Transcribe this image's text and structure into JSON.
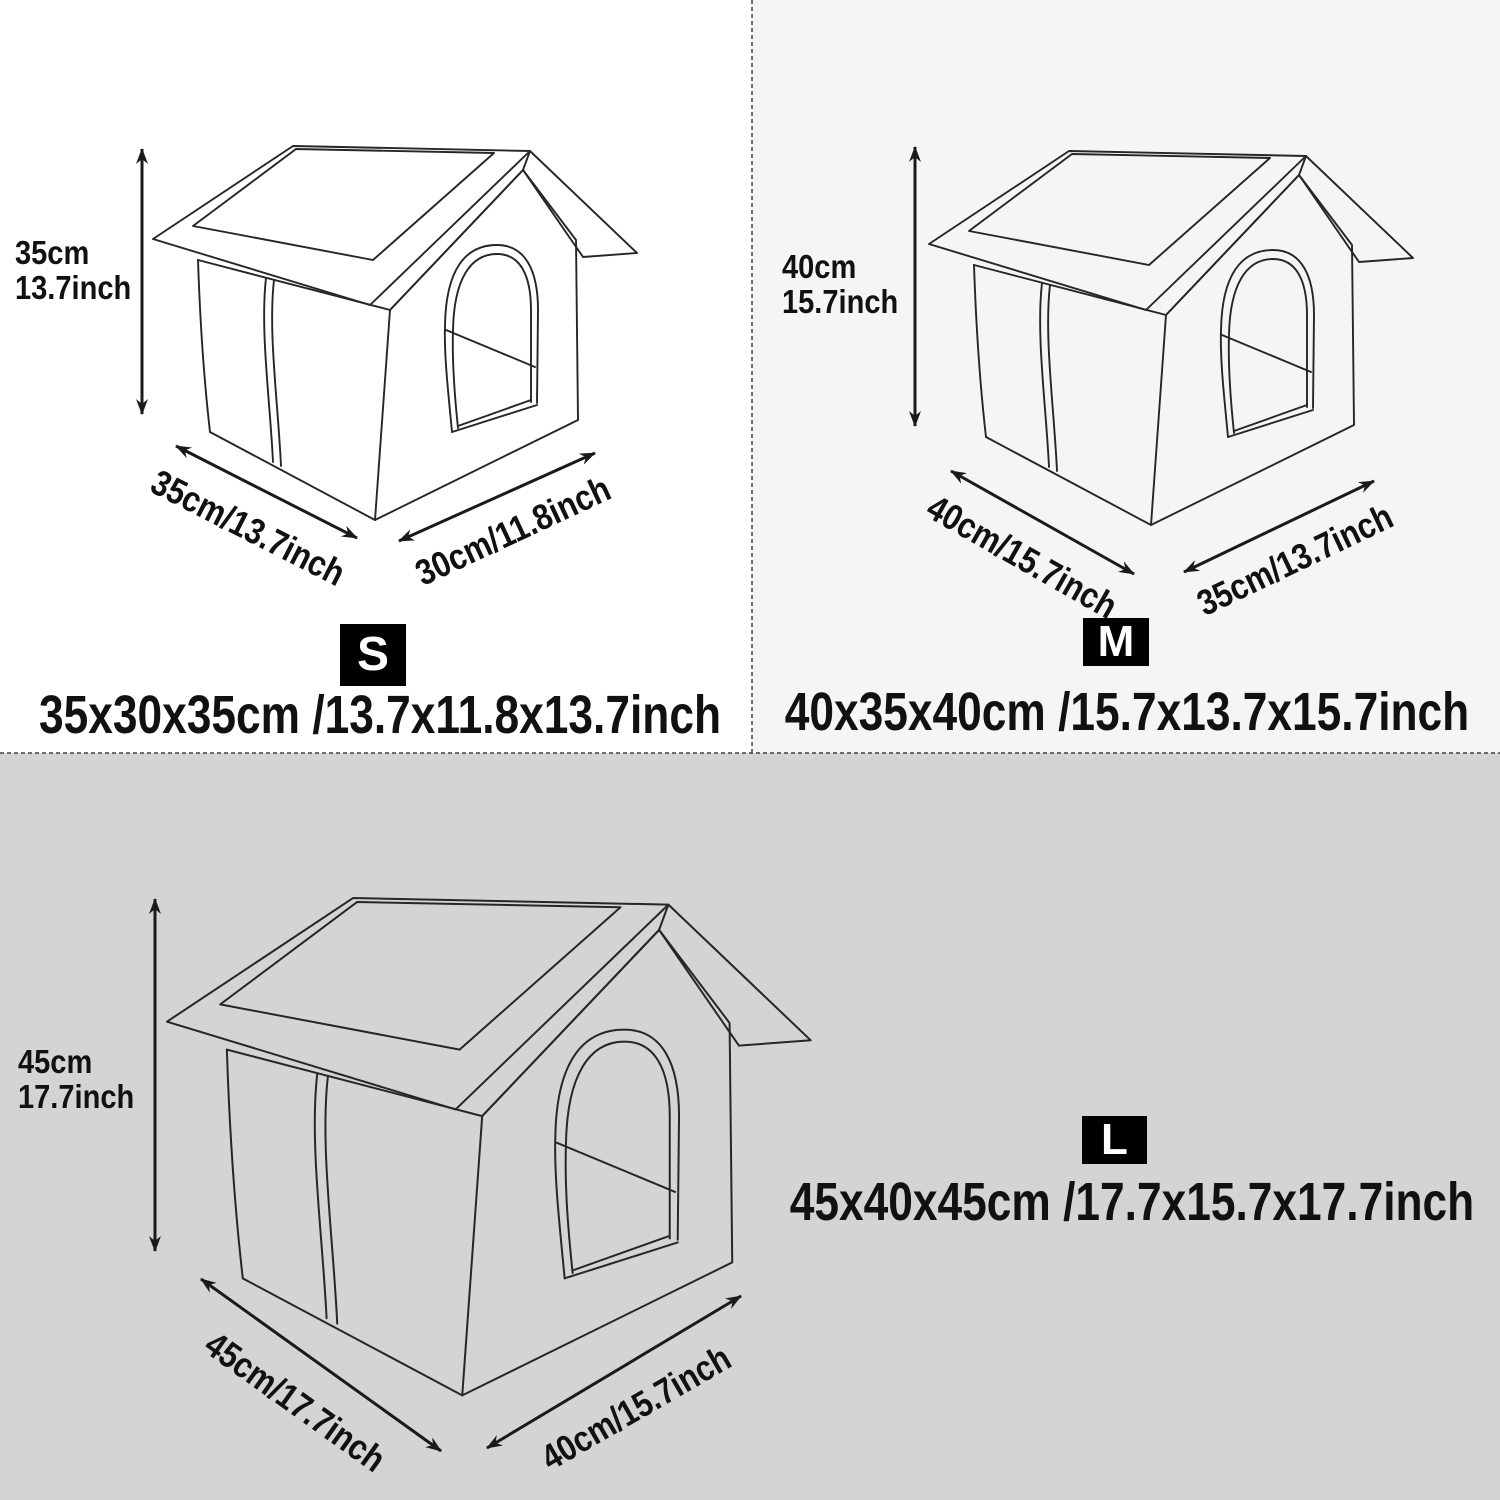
{
  "diagram": {
    "type": "product-size-chart",
    "subject": "house-shaped pet shelter line drawing",
    "sizes": [
      {
        "badge": "S",
        "height_cm": "35cm",
        "height_inch": "13.7inch",
        "width_label": "35cm/13.7inch",
        "depth_label": "30cm/11.8inch",
        "summary": "35x30x35cm /13.7x11.8x13.7inch"
      },
      {
        "badge": "M",
        "height_cm": "40cm",
        "height_inch": "15.7inch",
        "width_label": "40cm/15.7inch",
        "depth_label": "35cm/13.7inch",
        "summary": "40x35x40cm /15.7x13.7x15.7inch"
      },
      {
        "badge": "L",
        "height_cm": "45cm",
        "height_inch": "17.7inch",
        "width_label": "45cm/17.7inch",
        "depth_label": "40cm/15.7inch",
        "summary": "45x40x45cm /17.7x15.7x17.7inch"
      }
    ],
    "colors": {
      "panel_s_bg": "#ffffff",
      "panel_m_bg": "#f5f5f5",
      "panel_l_bg": "#d4d4d4",
      "line": "#262626",
      "arrow": "#1a1a1a",
      "text": "#111111",
      "badge_bg": "#000000",
      "badge_text": "#ffffff",
      "divider": "#404040"
    },
    "icons": {
      "dimension_arrow": "double-headed measurement arrow"
    }
  }
}
